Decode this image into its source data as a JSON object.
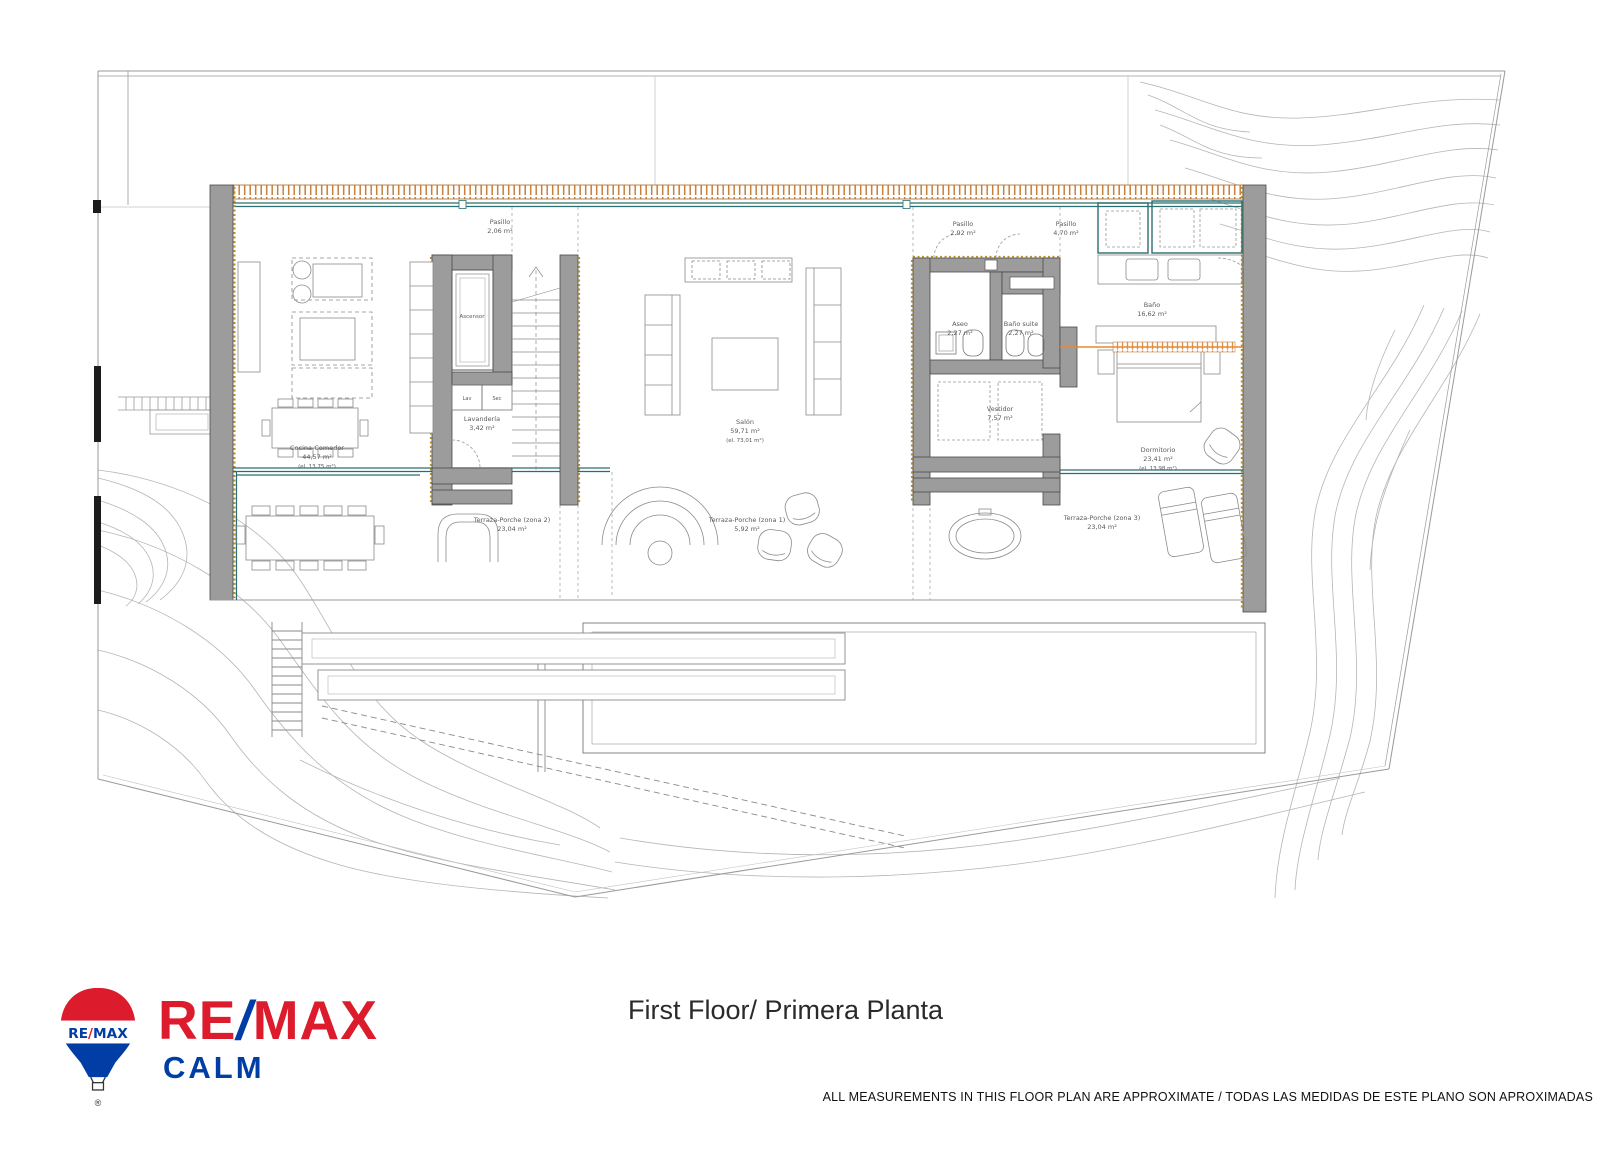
{
  "title": "First Floor/ Primera Planta",
  "disclaimer": "ALL MEASUREMENTS IN THIS FLOOR PLAN ARE APPROXIMATE / TODAS LAS MEDIDAS DE ESTE PLANO SON APROXIMADAS",
  "logo": {
    "re": "RE",
    "slash": "/",
    "max": "MAX",
    "sub": "CALM",
    "balloon_re": "RE",
    "balloon_slash": "/",
    "balloon_max": "MAX",
    "trademark": "®"
  },
  "colors": {
    "remax_red": "#dc1b2d",
    "remax_blue": "#003da5",
    "wall_grey": "#9c9c9c",
    "glazing_teal": "#2a6f6f",
    "accent_orange": "#e8882d",
    "insulation_gold": "#b9902e"
  },
  "rooms": {
    "pasillo1": {
      "name": "Pasillo",
      "area": "2,06 m²"
    },
    "pasillo2": {
      "name": "Pasillo",
      "area": "2,92 m²"
    },
    "pasillo3": {
      "name": "Pasillo",
      "area": "4,70 m²"
    },
    "ascensor": {
      "name": "Ascensor"
    },
    "lav": {
      "name": "Lav"
    },
    "sec": {
      "name": "Sec"
    },
    "lavanderia": {
      "name": "Lavandería",
      "area": "3,42 m²"
    },
    "cocina": {
      "name": "Cocina-Comedor",
      "area": "44,57 m²",
      "extra": "(el. 13,75 m²)"
    },
    "salon": {
      "name": "Salón",
      "area": "59,71 m²",
      "extra": "(el. 73,01 m²)"
    },
    "aseo": {
      "name": "Aseo",
      "area": "2,27 m²"
    },
    "bano_suite": {
      "name": "Baño suite",
      "area": "2,27 m²"
    },
    "bano": {
      "name": "Baño",
      "area": "16,62 m²"
    },
    "vestidor": {
      "name": "Vestidor",
      "area": "7,57 m²"
    },
    "dormitorio": {
      "name": "Dormitorio",
      "area": "23,41 m²",
      "extra": "(el. 13,98 m²)"
    },
    "terraza1": {
      "name": "Terraza-Porche (zona 1)",
      "area": "5,92 m²"
    },
    "terraza2": {
      "name": "Terraza-Porche (zona 2)",
      "area": "23,04 m²"
    },
    "terraza3": {
      "name": "Terraza-Porche (zona 3)",
      "area": "23,04 m²"
    }
  }
}
